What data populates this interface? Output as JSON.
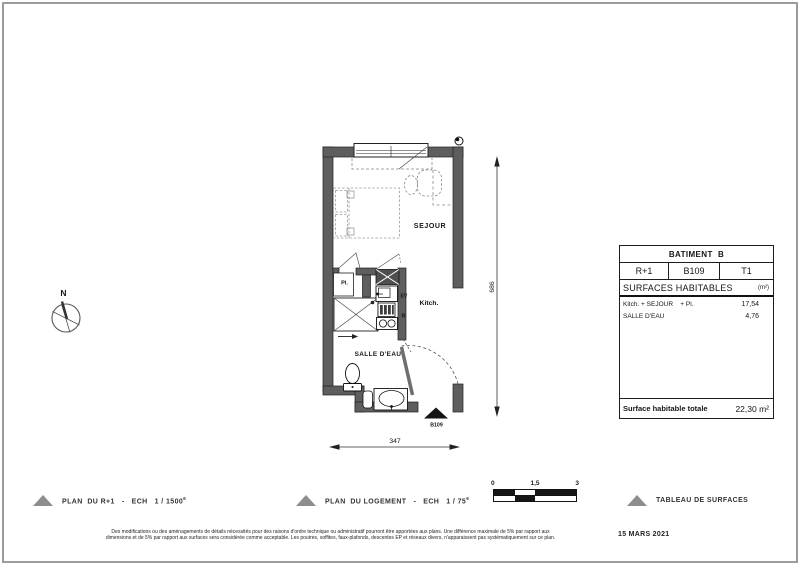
{
  "page": {
    "date": "15 MARS 2021",
    "disclaimer": {
      "line1": "Des modifications ou des aménagements de détails nécessités pour des raisons d'ordre technique ou administratif pourront être apportées aux plans. Une différence maximale de 5% par rapport aux",
      "line2": "dimensions et de 5% par rapport aux surfaces sera considérée comme acceptable. Les poutres, soffites, faux-plafonds, descentes EP et réseaux divers, n'apparaissent pas systématiquement sur ce plan."
    },
    "border_color": "#9c9c9c"
  },
  "compass": {
    "north_label": "N"
  },
  "plan": {
    "labels": {
      "sejour": "SEJOUR",
      "kitchen": "Kitch.",
      "bathroom": "SALLE D'EAU",
      "closet": "Pl.",
      "sink": "EV",
      "fridge": "R",
      "entrance_unit": "B109"
    },
    "dimensions": {
      "height": "686",
      "width": "347"
    },
    "wall_color": "#5e5e5e"
  },
  "surface_table": {
    "header": "BATIMENT  B",
    "floor": "R+1",
    "unit": "B109",
    "type": "T1",
    "section_title": "SURFACES HABITABLES",
    "section_unit": "(m²)",
    "rows": [
      {
        "label": "Kitch. + SEJOUR    + Pl.",
        "value": "17,54"
      },
      {
        "label": "SALLE D'EAU",
        "value": "4,76"
      }
    ],
    "total_label": "Surface habitable totale",
    "total_value": "22,30 m²"
  },
  "legend": {
    "plan_r1": {
      "label": "PLAN  DU R+1   -   ECH   1 / 1500",
      "sup": "e"
    },
    "plan_logement": {
      "label": "PLAN  DU LOGEMENT   -   ECH   1 / 75",
      "sup": "e"
    },
    "tableau": {
      "label": "TABLEAU DE SURFACES"
    },
    "triangle_color": "#8d8d8d"
  },
  "scale_bar": {
    "ticks": [
      "0",
      "1,5",
      "3"
    ]
  }
}
